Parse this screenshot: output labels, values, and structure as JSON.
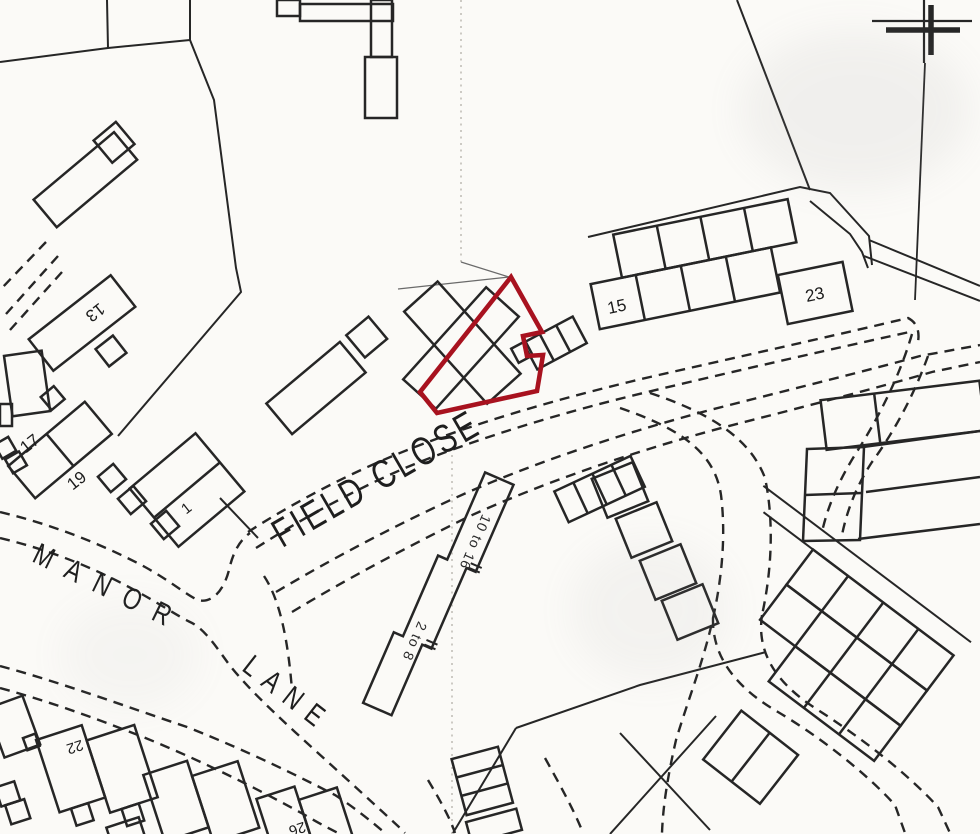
{
  "map": {
    "street_labels": {
      "field_close": "FIELD CLOSE",
      "manor": "MANOR",
      "lane": "LANE"
    },
    "house_numbers": {
      "n15": "15",
      "n23": "23",
      "n13": "13",
      "n17": "17",
      "n19": "19",
      "n1": "1",
      "n22": "22",
      "n26": "26"
    },
    "range_labels": {
      "r2_8": "2 to 8",
      "r10_16": "10 to 16"
    },
    "colors": {
      "highlight_plot": "#a8121f",
      "ink": "#262626",
      "paper": "#fbfaf7",
      "faint_grid": "#b9b5ae"
    }
  }
}
